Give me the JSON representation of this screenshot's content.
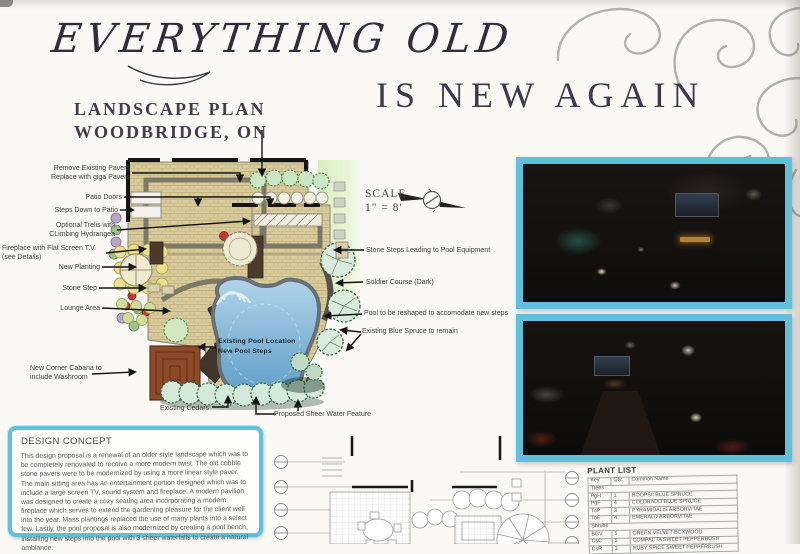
{
  "board": {
    "title_script": "EVERYTHING OLD",
    "title_serif": "IS NEW AGAIN",
    "subtitle_line1": "LANDSCAPE PLAN",
    "subtitle_line2": "WOODBRIDGE, ON"
  },
  "plan": {
    "scale_label": "SCALE",
    "scale_value": "1\" = 8'",
    "pool_label": "Existing Pool Location\nNew Pool Steps",
    "labels_left": [
      {
        "text": "Remove Existing Pavers\nReplace with giga Pavers"
      },
      {
        "text": "Patio Doors"
      },
      {
        "text": "Steps Down to Patio"
      },
      {
        "text": "Optional Trelis with\nCLimbing Hydrangea"
      },
      {
        "text": "Fireplace with Flat Screen T.V.\n(see Details)"
      },
      {
        "text": "New Planting"
      },
      {
        "text": "Stone Step"
      },
      {
        "text": "Lounge Area"
      },
      {
        "text": "New Corner Cabana to\ninclude Washroom"
      }
    ],
    "labels_right": [
      {
        "text": "Stone Steps Leading to Pool Equipment"
      },
      {
        "text": "Soldier Course (Dark)"
      },
      {
        "text": "Pool to be reshaped to accomodate new steps"
      },
      {
        "text": "Existing Blue Spruce to remain"
      }
    ],
    "labels_bottom": [
      {
        "text": "Existing Cedars"
      },
      {
        "text": "Proposed Sheer Water Feature"
      }
    ]
  },
  "design_concept": {
    "title": "DESIGN CONCEPT",
    "body": "This design proposal is a renewal of an older style landscape which was to be completely renovated to receive a more modern twist. The old cobble stone pavers were to be modernized by using a more linear style paver. The main sitting area has an entertainment portion designed which was to include a large screen TV, sound system and fireplace. A modern pavilion was designed to create a cozy seating area incorporating a modern fireplace which serves to extend the gardening pleasure for the client well into the year. Mass plantings replaced the use of many plants into a select few.  Lastly, the pool proposal is also modernized by creating a pool bench, installing new steps into the pool with 3 sheer waterfalls to create a natural ambiance."
  },
  "plant_list": {
    "title": "PLANT LIST",
    "headers": [
      "Key",
      "Qty.",
      "Common Name"
    ],
    "sections": [
      {
        "name": "Trees",
        "rows": [
          {
            "key": "PgH",
            "qty": "1",
            "name": "HOOPSII BLUE SPRUCE"
          },
          {
            "key": "PgF",
            "qty": "4",
            "name": "COLORADO BLUE SPRUCE"
          },
          {
            "key": "ToP",
            "qty": "3",
            "name": "PYRAMIDALIS ARBORVITAE"
          },
          {
            "key": "ToE",
            "qty": "4",
            "name": "EMERALD ARBORVITAE"
          }
        ]
      },
      {
        "name": "Shrubs",
        "rows": [
          {
            "key": "BGV",
            "qty": "5",
            "name": "GREEN VELVET BOXWOOD"
          },
          {
            "key": "CsC",
            "qty": "5",
            "name": "COMPACTA SWEET PEPPERBUSH"
          },
          {
            "key": "CsR",
            "qty": "3",
            "name": "RUBY SPICE SWEET PEPPERBUSH"
          }
        ]
      }
    ]
  },
  "colors": {
    "accent_cyan": "#5fc0dd",
    "pool_blue": "#6fa8d2",
    "paver_tan": "#d8cc9d",
    "title_ink": "#312e3c"
  }
}
